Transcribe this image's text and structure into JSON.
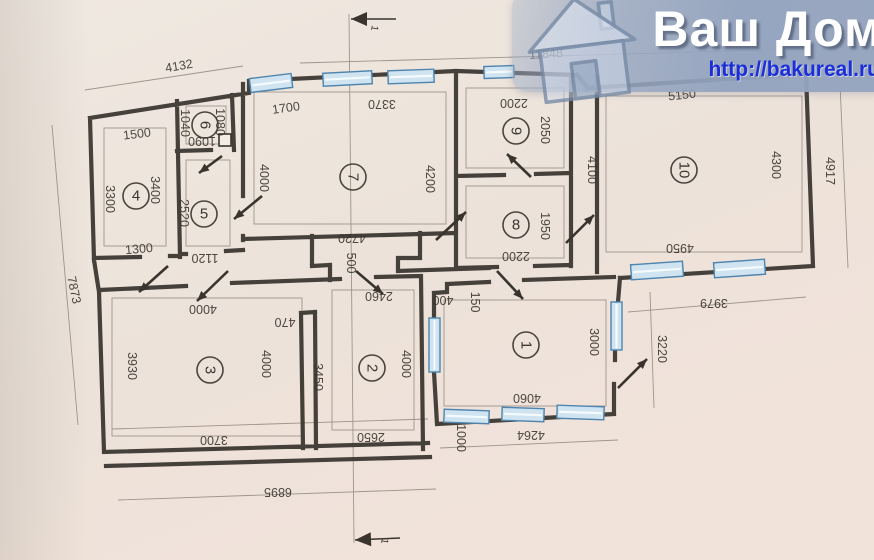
{
  "header": {
    "title": "Ваш Дом",
    "url": "http://bakureal.ru",
    "overlay_color": "#96a7c2",
    "title_color": "#ffffff",
    "url_color": "#1b2ed8",
    "logo": "house-icon"
  },
  "plan": {
    "ink_color": "#39342e",
    "paper_color": "#ece4db",
    "window_color": "#cfe3f0",
    "window_border_color": "#4e84ad",
    "rooms": [
      {
        "number": "1",
        "x": 526,
        "y": 345,
        "r": 90
      },
      {
        "number": "2",
        "x": 372,
        "y": 368,
        "r": 90
      },
      {
        "number": "3",
        "x": 210,
        "y": 370,
        "r": 90
      },
      {
        "number": "4",
        "x": 136,
        "y": 196,
        "r": 0
      },
      {
        "number": "5",
        "x": 204,
        "y": 214,
        "r": 0
      },
      {
        "number": "6",
        "x": 205,
        "y": 125,
        "r": 90
      },
      {
        "number": "7",
        "x": 353,
        "y": 177,
        "r": 90
      },
      {
        "number": "8",
        "x": 516,
        "y": 225,
        "r": 0
      },
      {
        "number": "9",
        "x": 516,
        "y": 131,
        "r": 90
      },
      {
        "number": "10",
        "x": 684,
        "y": 170,
        "r": 90
      }
    ],
    "dimensions": [
      {
        "t": "4132",
        "x": 179,
        "y": 66,
        "r": -10
      },
      {
        "t": "11848",
        "x": 546,
        "y": 54,
        "r": -4
      },
      {
        "t": "5150",
        "x": 682,
        "y": 95,
        "r": -6
      },
      {
        "t": "1500",
        "x": 137,
        "y": 134,
        "r": -7
      },
      {
        "t": "1700",
        "x": 286,
        "y": 108,
        "r": -8
      },
      {
        "t": "3370",
        "x": 382,
        "y": 104,
        "r": 180
      },
      {
        "t": "2200",
        "x": 514,
        "y": 103,
        "r": 180
      },
      {
        "t": "1040",
        "x": 185,
        "y": 123,
        "r": 90
      },
      {
        "t": "1080",
        "x": 220,
        "y": 122,
        "r": 90
      },
      {
        "t": "1090",
        "x": 202,
        "y": 141,
        "r": 180
      },
      {
        "t": "2050",
        "x": 545,
        "y": 130,
        "r": 90
      },
      {
        "t": "3300",
        "x": 110,
        "y": 199,
        "r": 90
      },
      {
        "t": "3400",
        "x": 155,
        "y": 190,
        "r": 90
      },
      {
        "t": "2520",
        "x": 184,
        "y": 213,
        "r": 90
      },
      {
        "t": "4000",
        "x": 264,
        "y": 178,
        "r": 90
      },
      {
        "t": "4200",
        "x": 430,
        "y": 179,
        "r": 90
      },
      {
        "t": "4100",
        "x": 592,
        "y": 170,
        "r": 90
      },
      {
        "t": "4300",
        "x": 776,
        "y": 165,
        "r": 90
      },
      {
        "t": "4917",
        "x": 830,
        "y": 171,
        "r": 90
      },
      {
        "t": "1300",
        "x": 139,
        "y": 249,
        "r": -5
      },
      {
        "t": "1120",
        "x": 205,
        "y": 258,
        "r": 180
      },
      {
        "t": "4720",
        "x": 352,
        "y": 238,
        "r": 180
      },
      {
        "t": "500",
        "x": 351,
        "y": 263,
        "r": 90
      },
      {
        "t": "1950",
        "x": 545,
        "y": 226,
        "r": 90
      },
      {
        "t": "2200",
        "x": 516,
        "y": 256,
        "r": 180
      },
      {
        "t": "4950",
        "x": 680,
        "y": 248,
        "r": 180
      },
      {
        "t": "3979",
        "x": 714,
        "y": 303,
        "r": 180
      },
      {
        "t": "4000",
        "x": 203,
        "y": 309,
        "r": 180
      },
      {
        "t": "3930",
        "x": 132,
        "y": 366,
        "r": 90
      },
      {
        "t": "4000",
        "x": 266,
        "y": 364,
        "r": 90
      },
      {
        "t": "3700",
        "x": 214,
        "y": 440,
        "r": 180
      },
      {
        "t": "470",
        "x": 285,
        "y": 322,
        "r": 180
      },
      {
        "t": "3450",
        "x": 318,
        "y": 377,
        "r": 90
      },
      {
        "t": "2460",
        "x": 379,
        "y": 296,
        "r": 180
      },
      {
        "t": "4000",
        "x": 406,
        "y": 364,
        "r": 90
      },
      {
        "t": "2650",
        "x": 371,
        "y": 437,
        "r": 180
      },
      {
        "t": "400",
        "x": 443,
        "y": 300,
        "r": 180
      },
      {
        "t": "150",
        "x": 475,
        "y": 302,
        "r": 90
      },
      {
        "t": "3000",
        "x": 594,
        "y": 342,
        "r": 90
      },
      {
        "t": "4060",
        "x": 527,
        "y": 398,
        "r": 180
      },
      {
        "t": "4264",
        "x": 531,
        "y": 435,
        "r": 180
      },
      {
        "t": "1000",
        "x": 461,
        "y": 438,
        "r": 90
      },
      {
        "t": "3220",
        "x": 662,
        "y": 349,
        "r": 90
      },
      {
        "t": "7873",
        "x": 74,
        "y": 290,
        "r": 78
      },
      {
        "t": "6895",
        "x": 278,
        "y": 492,
        "r": 180
      }
    ],
    "section_marks": [
      {
        "t": "1",
        "x": 374,
        "y": 28,
        "r": 100
      },
      {
        "t": "1",
        "x": 384,
        "y": 541,
        "r": 100
      }
    ]
  }
}
